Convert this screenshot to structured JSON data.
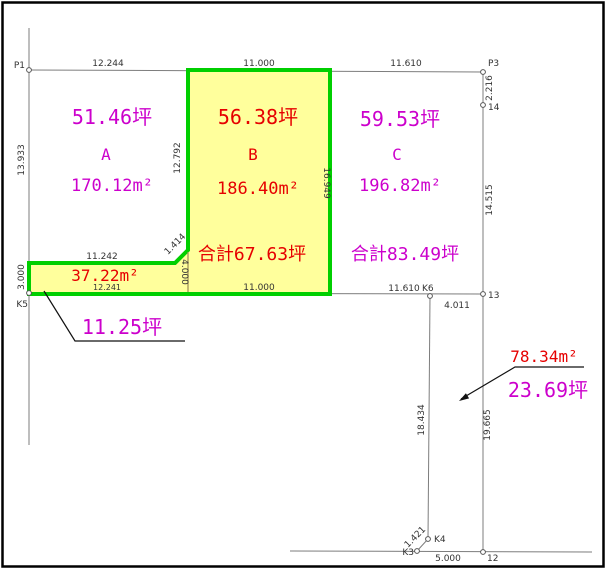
{
  "colors": {
    "dim": "#333333",
    "magenta": "#cc00cc",
    "red": "#e60000",
    "parcel_fill": "#ffff9c",
    "parcel_outline": "#00cf00",
    "survey_line": "#7d7d7d",
    "divider": "#9a8a55",
    "leader": "#111111",
    "frame": "#000000"
  },
  "labels": [
    {
      "name": "point-label-p1",
      "text": "P1",
      "x": 25,
      "y": 68,
      "anchor": "end"
    },
    {
      "name": "dim-top-segment-1",
      "text": "12.244",
      "x": 108,
      "y": 66,
      "anchor": "middle"
    },
    {
      "name": "dim-top-segment-2",
      "text": "11.000",
      "x": 259,
      "y": 66,
      "anchor": "middle"
    },
    {
      "name": "dim-top-segment-3",
      "text": "11.610",
      "x": 406,
      "y": 66,
      "anchor": "middle"
    },
    {
      "name": "point-label-p3",
      "text": "P3",
      "x": 488,
      "y": 66,
      "anchor": "start"
    },
    {
      "name": "dim-right-segment-1",
      "text": "2.216",
      "x": 492,
      "y": 88,
      "anchor": "middle",
      "rotate": -90
    },
    {
      "name": "point-label-14",
      "text": "14",
      "x": 488,
      "y": 110,
      "anchor": "start"
    },
    {
      "name": "dim-right-segment-2",
      "text": "14.515",
      "x": 492,
      "y": 200,
      "anchor": "middle",
      "rotate": -90
    },
    {
      "name": "point-label-13",
      "text": "13",
      "x": 488,
      "y": 298,
      "anchor": "start"
    },
    {
      "name": "dim-left-segment-1",
      "text": "13.933",
      "x": 24,
      "y": 160,
      "anchor": "middle",
      "rotate": -90
    },
    {
      "name": "dim-ab-divider",
      "text": "12.792",
      "x": 180,
      "y": 158,
      "anchor": "middle",
      "rotate": -90
    },
    {
      "name": "dim-bc-divider",
      "text": "16.949",
      "x": 324,
      "y": 183,
      "anchor": "middle",
      "rotate": 90
    },
    {
      "name": "dim-strip-top",
      "text": "11.242",
      "x": 102,
      "y": 259,
      "anchor": "middle"
    },
    {
      "name": "dim-strip-diagonal",
      "text": "1.414",
      "x": 177,
      "y": 246,
      "anchor": "middle",
      "rotate": -45
    },
    {
      "name": "dim-strip-divider",
      "text": "4.000",
      "x": 182,
      "y": 272,
      "anchor": "middle",
      "rotate": 90
    },
    {
      "name": "dim-left-segment-2",
      "text": "3.000",
      "x": 24,
      "y": 277,
      "anchor": "middle",
      "rotate": -90
    },
    {
      "name": "point-label-k5",
      "text": "K5",
      "x": 28,
      "y": 307,
      "anchor": "end"
    },
    {
      "name": "dim-strip-bottom",
      "text": "12.241",
      "x": 107,
      "y": 290,
      "anchor": "middle",
      "size": 8
    },
    {
      "name": "dim-bottom-segment-2",
      "text": "11.000",
      "x": 259,
      "y": 290,
      "anchor": "middle"
    },
    {
      "name": "dim-bottom-segment-3",
      "text": "11.610",
      "x": 404,
      "y": 291,
      "anchor": "middle"
    },
    {
      "name": "point-label-k6",
      "text": "K6",
      "x": 422,
      "y": 291,
      "anchor": "start"
    },
    {
      "name": "dim-k6-to-13",
      "text": "4.011",
      "x": 457,
      "y": 308,
      "anchor": "middle"
    },
    {
      "name": "dim-k6-vertical",
      "text": "18.434",
      "x": 424,
      "y": 420,
      "anchor": "middle",
      "rotate": -90
    },
    {
      "name": "dim-right-segment-3",
      "text": "19.665",
      "x": 490,
      "y": 425,
      "anchor": "middle",
      "rotate": -90
    },
    {
      "name": "point-label-k3",
      "text": "K3",
      "x": 414,
      "y": 555,
      "anchor": "end"
    },
    {
      "name": "dim-k3-k4-diagonal",
      "text": "1.421",
      "x": 417,
      "y": 539,
      "anchor": "middle",
      "rotate": -45
    },
    {
      "name": "point-label-k4",
      "text": "K4",
      "x": 434,
      "y": 542,
      "anchor": "start"
    },
    {
      "name": "dim-bottom-road",
      "text": "5.000",
      "x": 448,
      "y": 561,
      "anchor": "middle"
    },
    {
      "name": "point-label-12",
      "text": "12",
      "x": 487,
      "y": 561,
      "anchor": "start"
    },
    {
      "name": "plot-a-tsubo",
      "text": "51.46坪",
      "x": 112,
      "y": 124,
      "anchor": "middle",
      "color": "magenta",
      "size": 20,
      "mono": true
    },
    {
      "name": "plot-a-letter",
      "text": "A",
      "x": 106,
      "y": 160,
      "anchor": "middle",
      "color": "magenta",
      "size": 16,
      "mono": true
    },
    {
      "name": "plot-a-area",
      "text": "170.12m²",
      "x": 112,
      "y": 191,
      "anchor": "middle",
      "color": "magenta",
      "size": 17,
      "mono": true
    },
    {
      "name": "plot-b-tsubo",
      "text": "56.38坪",
      "x": 258,
      "y": 124,
      "anchor": "middle",
      "color": "red",
      "size": 20,
      "mono": true
    },
    {
      "name": "plot-b-letter",
      "text": "B",
      "x": 253,
      "y": 160,
      "anchor": "middle",
      "color": "red",
      "size": 16,
      "mono": true
    },
    {
      "name": "plot-b-area",
      "text": "186.40m²",
      "x": 258,
      "y": 194,
      "anchor": "middle",
      "color": "red",
      "size": 17,
      "mono": true
    },
    {
      "name": "plot-c-tsubo",
      "text": "59.53坪",
      "x": 400,
      "y": 126,
      "anchor": "middle",
      "color": "magenta",
      "size": 20,
      "mono": true
    },
    {
      "name": "plot-c-letter",
      "text": "C",
      "x": 397,
      "y": 160,
      "anchor": "middle",
      "color": "magenta",
      "size": 16,
      "mono": true
    },
    {
      "name": "plot-c-area",
      "text": "196.82m²",
      "x": 400,
      "y": 191,
      "anchor": "middle",
      "color": "magenta",
      "size": 17,
      "mono": true
    },
    {
      "name": "total-left",
      "text": "合計67.63坪",
      "x": 252,
      "y": 260,
      "anchor": "middle",
      "color": "red",
      "size": 18,
      "mono": true
    },
    {
      "name": "total-right",
      "text": "合計83.49坪",
      "x": 405,
      "y": 260,
      "anchor": "middle",
      "color": "magenta",
      "size": 18,
      "mono": true
    },
    {
      "name": "strip-area-m2",
      "text": "37.22m²",
      "x": 105,
      "y": 281,
      "anchor": "middle",
      "color": "red",
      "size": 16,
      "mono": true
    },
    {
      "name": "strip-tsubo",
      "text": "11.25坪",
      "x": 122,
      "y": 334,
      "anchor": "middle",
      "color": "magenta",
      "size": 20,
      "mono": true
    },
    {
      "name": "detached-area-m2",
      "text": "78.34m²",
      "x": 544,
      "y": 362,
      "anchor": "middle",
      "color": "red",
      "size": 16,
      "mono": true
    },
    {
      "name": "detached-tsubo",
      "text": "23.69坪",
      "x": 548,
      "y": 397,
      "anchor": "middle",
      "color": "magenta",
      "size": 20,
      "mono": true
    }
  ],
  "points": [
    {
      "name": "survey-point-p1",
      "x": 29,
      "y": 70
    },
    {
      "name": "survey-point-p3",
      "x": 483,
      "y": 72
    },
    {
      "name": "survey-point-14",
      "x": 483,
      "y": 105
    },
    {
      "name": "survey-point-13",
      "x": 483,
      "y": 294
    },
    {
      "name": "survey-point-k6",
      "x": 430,
      "y": 296
    },
    {
      "name": "survey-point-k5",
      "x": 29,
      "y": 293
    },
    {
      "name": "survey-point-12",
      "x": 483,
      "y": 552
    },
    {
      "name": "survey-point-k3",
      "x": 417,
      "y": 551
    },
    {
      "name": "survey-point-k4",
      "x": 428,
      "y": 539
    }
  ]
}
